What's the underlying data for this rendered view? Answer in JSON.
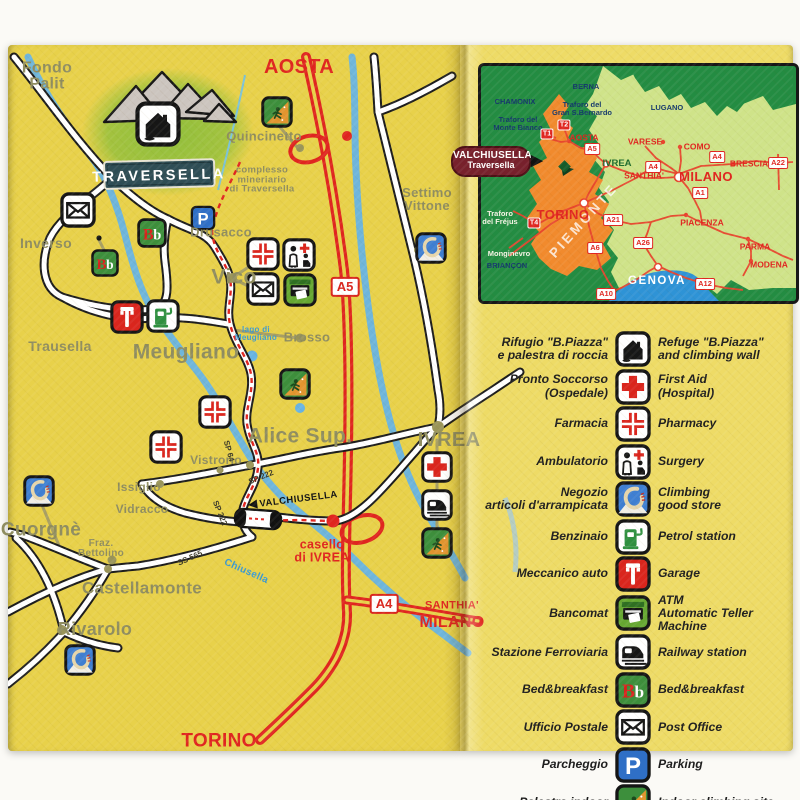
{
  "map": {
    "logo": {
      "title": "TRAVERSELLA"
    },
    "route_sign": {
      "arrow": "◀",
      "t": "VALCHIUSELLA"
    },
    "towns": [
      {
        "t": "Fondo\nPalit",
        "x": 47,
        "y": 77,
        "s": 16
      },
      {
        "t": "Inverso",
        "x": 46,
        "y": 243,
        "s": 14
      },
      {
        "t": "Trausella",
        "x": 60,
        "y": 346,
        "s": 14
      },
      {
        "t": "Drusacco",
        "x": 221,
        "y": 232,
        "s": 13
      },
      {
        "t": "Vico",
        "x": 234,
        "y": 277,
        "s": 21
      },
      {
        "t": "Meugliano",
        "x": 186,
        "y": 352,
        "s": 21
      },
      {
        "t": "Brosso",
        "x": 307,
        "y": 337,
        "s": 13
      },
      {
        "t": "Alice Sup.",
        "x": 300,
        "y": 436,
        "s": 21
      },
      {
        "t": "Vistrorio",
        "x": 216,
        "y": 460,
        "s": 12
      },
      {
        "t": "Issiglio",
        "x": 139,
        "y": 487,
        "s": 12
      },
      {
        "t": "Vidracco",
        "x": 142,
        "y": 509,
        "s": 12
      },
      {
        "t": "Cuorgnè",
        "x": 41,
        "y": 530,
        "s": 19
      },
      {
        "t": "Fraz.\nBettolino",
        "x": 101,
        "y": 549,
        "s": 10
      },
      {
        "t": "Castellamonte",
        "x": 142,
        "y": 588,
        "s": 17
      },
      {
        "t": "Rivarolo",
        "x": 95,
        "y": 629,
        "s": 18
      },
      {
        "t": "Quincinetto",
        "x": 264,
        "y": 136,
        "s": 13
      },
      {
        "t": "Settimo\nVittone",
        "x": 427,
        "y": 199,
        "s": 13
      },
      {
        "t": "IVREA",
        "x": 449,
        "y": 440,
        "s": 20
      },
      {
        "t": "complesso\nmineriario\ndi Traversella",
        "x": 262,
        "y": 180,
        "s": 9.5
      },
      {
        "t": "lago di\nMeugliano",
        "x": 256,
        "y": 334,
        "s": 8,
        "c": "#3d9ad1"
      },
      {
        "t": "Chiusella",
        "x": 246,
        "y": 572,
        "s": 10,
        "c": "#3d9ad1",
        "r": 24
      }
    ],
    "red_labels": [
      {
        "t": "AOSTA",
        "x": 299,
        "y": 67,
        "s": 20
      },
      {
        "t": "TORINO",
        "x": 219,
        "y": 741,
        "s": 19
      },
      {
        "t": "SANTHIA'",
        "x": 452,
        "y": 606,
        "s": 11
      },
      {
        "t": "MILANO",
        "x": 452,
        "y": 623,
        "s": 16
      },
      {
        "t": "casello\ndi IVREA",
        "x": 322,
        "y": 551,
        "s": 12.5
      }
    ],
    "badges": [
      {
        "t": "A5",
        "x": 345,
        "y": 287
      },
      {
        "t": "A4",
        "x": 384,
        "y": 604
      }
    ],
    "road_labels": [
      {
        "t": "SP 64",
        "x": 229,
        "y": 451,
        "r": 75
      },
      {
        "t": "SP 222",
        "x": 261,
        "y": 477,
        "r": -22
      },
      {
        "t": "SP 222",
        "x": 220,
        "y": 513,
        "r": 68
      },
      {
        "t": "SS 565",
        "x": 190,
        "y": 558,
        "r": -24
      }
    ],
    "icons": [
      {
        "k": "post",
        "x": 78,
        "y": 210,
        "s": 36
      },
      {
        "k": "parking",
        "x": 203,
        "y": 218,
        "s": 25
      },
      {
        "k": "bnb",
        "x": 152,
        "y": 233,
        "s": 30
      },
      {
        "k": "bnb",
        "x": 105,
        "y": 263,
        "s": 28
      },
      {
        "k": "indoor",
        "x": 277,
        "y": 112,
        "s": 32
      },
      {
        "k": "carabiner",
        "x": 431,
        "y": 248,
        "s": 32
      },
      {
        "k": "pharmacy",
        "x": 263,
        "y": 254,
        "s": 34
      },
      {
        "k": "surgery",
        "x": 299,
        "y": 255,
        "s": 34
      },
      {
        "k": "post",
        "x": 263,
        "y": 289,
        "s": 34
      },
      {
        "k": "atm",
        "x": 300,
        "y": 290,
        "s": 34
      },
      {
        "k": "garage",
        "x": 127,
        "y": 317,
        "s": 34
      },
      {
        "k": "petrol",
        "x": 163,
        "y": 316,
        "s": 34
      },
      {
        "k": "indoor",
        "x": 295,
        "y": 384,
        "s": 32
      },
      {
        "k": "pharmacy",
        "x": 215,
        "y": 412,
        "s": 34
      },
      {
        "k": "pharmacy",
        "x": 166,
        "y": 447,
        "s": 34
      },
      {
        "k": "carabiner",
        "x": 39,
        "y": 491,
        "s": 32
      },
      {
        "k": "carabiner",
        "x": 80,
        "y": 660,
        "s": 32
      },
      {
        "k": "firstaid",
        "x": 437,
        "y": 467,
        "s": 32
      },
      {
        "k": "railway",
        "x": 437,
        "y": 505,
        "s": 32
      },
      {
        "k": "indoor",
        "x": 437,
        "y": 543,
        "s": 32
      }
    ]
  },
  "inset": {
    "sign": {
      "l1": "VALCHIUSELLA",
      "l2": "Traversella",
      "arrow": "▶"
    },
    "labels": [
      {
        "t": "BERNA",
        "x": 105,
        "y": 21,
        "cls": "navy"
      },
      {
        "t": "CHAMONIX",
        "x": 34,
        "y": 36,
        "cls": "navy"
      },
      {
        "t": "Traforo del\nMonte Bianco",
        "x": 37,
        "y": 58,
        "cls": "navy"
      },
      {
        "t": "Traforo del\nGran S.Bernardo",
        "x": 101,
        "y": 43,
        "cls": "navy"
      },
      {
        "t": "LUGANO",
        "x": 186,
        "y": 42,
        "cls": "navy"
      },
      {
        "t": "BRIANÇON",
        "x": 26,
        "y": 200,
        "cls": "navy"
      },
      {
        "t": "Traforo\ndel Fréjus",
        "x": 19,
        "y": 152,
        "cls": "white-sm"
      },
      {
        "t": "Monginevro",
        "x": 28,
        "y": 188,
        "cls": "white-sm"
      },
      {
        "t": "PIEMONTE",
        "x": 103,
        "y": 155,
        "cls": "piemonte",
        "r": -48
      },
      {
        "t": "GENOVA",
        "x": 176,
        "y": 215,
        "cls": "sea-label"
      },
      {
        "t": "AOSTA",
        "x": 103,
        "y": 72,
        "cls": "red"
      },
      {
        "t": "IVREA",
        "x": 136,
        "y": 98,
        "cls": "green"
      },
      {
        "t": "SANTHIA'",
        "x": 163,
        "y": 110,
        "cls": "red"
      },
      {
        "t": "VARESE",
        "x": 164,
        "y": 76,
        "cls": "red"
      },
      {
        "t": "COMO",
        "x": 216,
        "y": 81,
        "cls": "red"
      },
      {
        "t": "MILANO",
        "x": 225,
        "y": 111,
        "cls": "red-big"
      },
      {
        "t": "BRESCIA",
        "x": 268,
        "y": 98,
        "cls": "red"
      },
      {
        "t": "TORINO",
        "x": 82,
        "y": 149,
        "cls": "red-big"
      },
      {
        "t": "PIACENZA",
        "x": 221,
        "y": 157,
        "cls": "red"
      },
      {
        "t": "PARMA",
        "x": 274,
        "y": 181,
        "cls": "red"
      },
      {
        "t": "MODENA",
        "x": 288,
        "y": 199,
        "cls": "red"
      }
    ],
    "badges": [
      {
        "t": "A5",
        "x": 111,
        "y": 83
      },
      {
        "t": "A4",
        "x": 172,
        "y": 101
      },
      {
        "t": "A4",
        "x": 236,
        "y": 91
      },
      {
        "t": "A22",
        "x": 297,
        "y": 97
      },
      {
        "t": "A1",
        "x": 219,
        "y": 127
      },
      {
        "t": "A21",
        "x": 132,
        "y": 154
      },
      {
        "t": "A26",
        "x": 162,
        "y": 177
      },
      {
        "t": "A6",
        "x": 114,
        "y": 182
      },
      {
        "t": "A10",
        "x": 125,
        "y": 228
      },
      {
        "t": "A12",
        "x": 224,
        "y": 218
      }
    ],
    "t_badges": [
      {
        "t": "T1",
        "x": 66,
        "y": 68
      },
      {
        "t": "T2",
        "x": 83,
        "y": 59
      },
      {
        "t": "T4",
        "x": 53,
        "y": 157
      }
    ]
  },
  "legend": {
    "rows": [
      {
        "icon": "refuge",
        "it": "Rifugio \"B.Piazza\"\ne palestra di roccia",
        "en": "Refuge \"B.Piazza\"\nand climbing wall"
      },
      {
        "icon": "firstaid",
        "it": "Pronto Soccorso\n(Ospedale)",
        "en": "First Aid\n(Hospital)"
      },
      {
        "icon": "pharmacy",
        "it": "Farmacia",
        "en": "Pharmacy"
      },
      {
        "icon": "surgery",
        "it": "Ambulatorio",
        "en": "Surgery"
      },
      {
        "icon": "carabiner",
        "it": "Negozio\narticoli d'arrampicata",
        "en": "Climbing\ngood store"
      },
      {
        "icon": "petrol",
        "it": "Benzinaio",
        "en": "Petrol station"
      },
      {
        "icon": "garage",
        "it": "Meccanico auto",
        "en": "Garage"
      },
      {
        "icon": "atm",
        "it": "Bancomat",
        "en": "ATM\nAutomatic Teller Machine"
      },
      {
        "icon": "railway",
        "it": "Stazione Ferroviaria",
        "en": "Railway station"
      },
      {
        "icon": "bnb",
        "it": "Bed&breakfast",
        "en": "Bed&breakfast"
      },
      {
        "icon": "post",
        "it": "Ufficio Postale",
        "en": "Post Office"
      },
      {
        "icon": "parking",
        "it": "Parcheggio",
        "en": "Parking"
      },
      {
        "icon": "indoor",
        "it": "Palestra indoor",
        "en": "Indoor climbing site"
      }
    ]
  },
  "colors": {
    "map_bg": "#e8d14a",
    "panel_bg": "#eedb66",
    "town_label": "#8f8d60",
    "highway_red": "#e0251f",
    "river_blue": "#68b4e3",
    "inset_green": "#238c42",
    "inset_land": "#cfe389",
    "piemonte_orange": "#f18a2d",
    "sea_blue": "#2e93d6",
    "sign_maroon": "#77202c"
  }
}
